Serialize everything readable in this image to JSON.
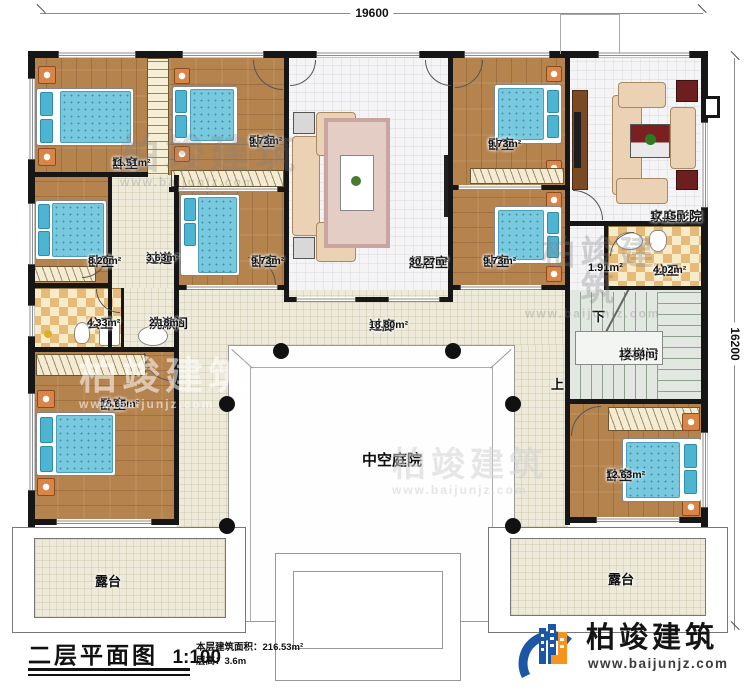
{
  "palette": {
    "wall": "#161616",
    "wood_floor": "#b5834e",
    "bed_blue": "#79c9de",
    "brand_blue": "#1c57a5",
    "brand_orange": "#f7941d"
  },
  "dimensions": {
    "top": "19600",
    "right": "16200"
  },
  "rooms": {
    "bedroom_tl": {
      "name": "卧室",
      "area": "11.51m²"
    },
    "bedroom_t2": {
      "name": "卧室",
      "area": "9.73m²"
    },
    "bedroom_tr": {
      "name": "卧室",
      "area": "9.73m²"
    },
    "home_theater": {
      "name": "家庭影院",
      "area": "17.15m²"
    },
    "bedroom_left": {
      "name": "卧室",
      "area": "8.20m²"
    },
    "hallway": {
      "name": "过道",
      "area": "3.63m²"
    },
    "bedroom_mid": {
      "name": "卧室",
      "area": "9.73m²"
    },
    "living": {
      "name": "起居室",
      "area": "30.27m²"
    },
    "bedroom_r2": {
      "name": "卧室",
      "area": "9.73m²"
    },
    "foyer": {
      "area": "1.91m²"
    },
    "bath_right": {
      "name": "公卫",
      "area": "4.02m²"
    },
    "bath_left": {
      "name": "公卫",
      "area": "4.33m²"
    },
    "washroom": {
      "name": "洗漱间",
      "area": "2.18m²"
    },
    "gallery": {
      "name": "过廊",
      "area": "18.80m²"
    },
    "stairwell": {
      "name": "楼梯间",
      "area": "12.64m²"
    },
    "bedroom_bl": {
      "name": "卧室",
      "area": "18.65m²"
    },
    "bedroom_br": {
      "name": "卧室",
      "area": "12.63m²"
    },
    "courtyard": {
      "name": "中空庭院"
    },
    "terrace_left": {
      "name": "露台"
    },
    "terrace_right": {
      "name": "露台"
    }
  },
  "stairs": {
    "down": "下",
    "up": "上"
  },
  "title_block": {
    "title": "二层平面图",
    "scale": "1:100",
    "area_label": "本层建筑面积：216.53m²",
    "floor_height": "层高：3.6m"
  },
  "brand": {
    "name": "柏竣建筑",
    "website": "www.baijunjz.com"
  },
  "watermark": {
    "text": "柏竣建筑",
    "url": "www.baijunjz.com"
  }
}
